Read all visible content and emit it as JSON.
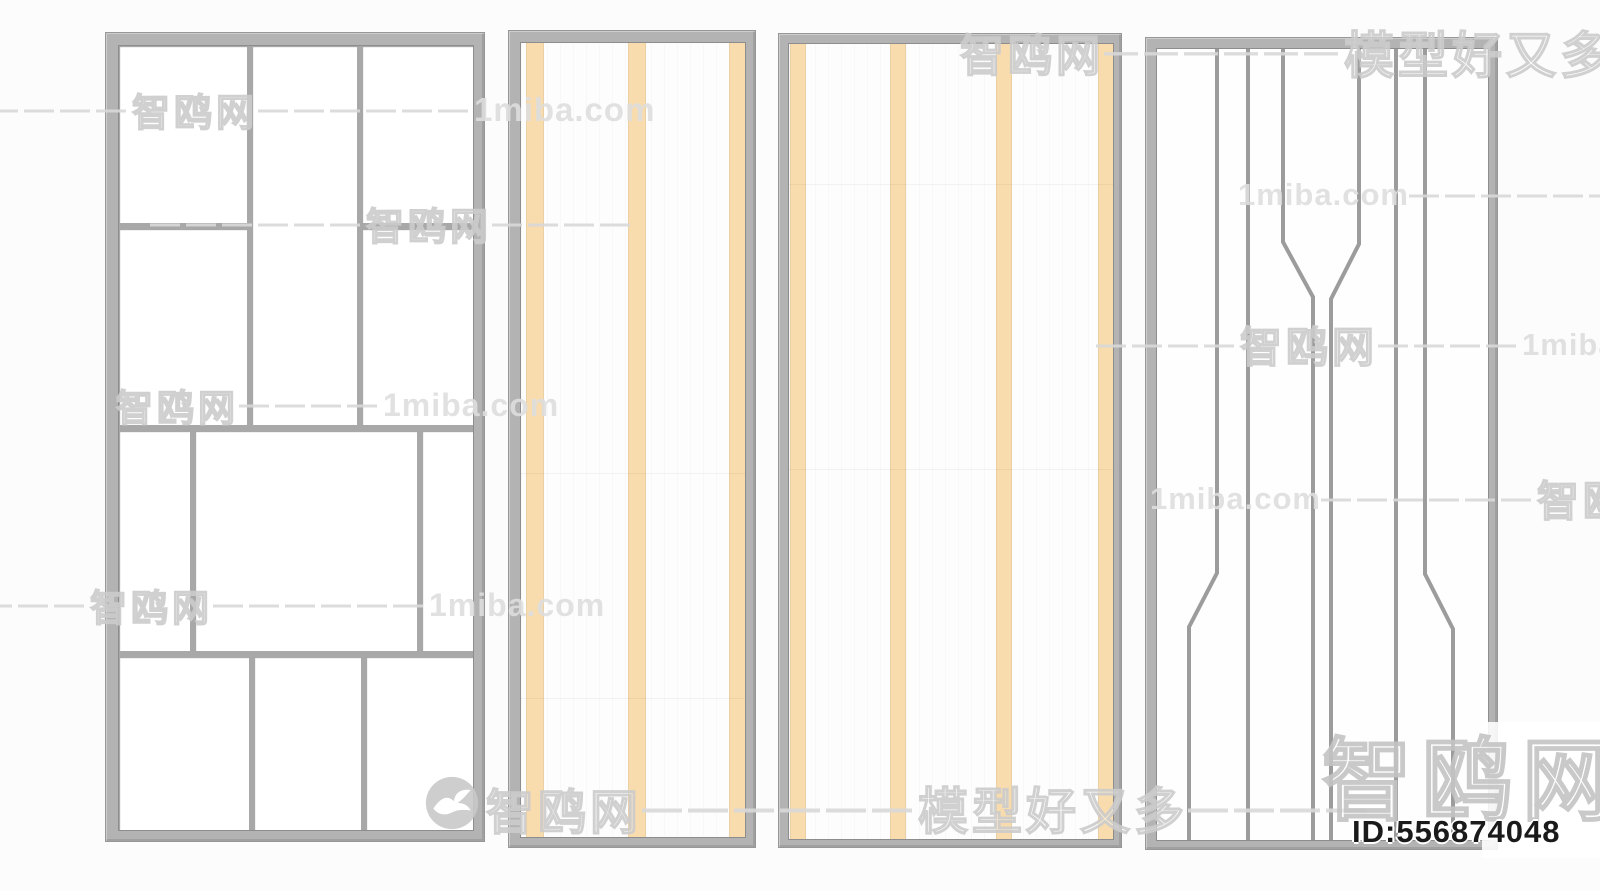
{
  "image": {
    "type": "3d-model-preview-render",
    "subject": "four decorative partition screen panels",
    "background_color": "#fcfcfc"
  },
  "watermarks": {
    "site_name": "智鸥网",
    "site_url": "1miba.com",
    "slogan": "模型好又多",
    "dashes_short": "———",
    "dashes_medium": "————",
    "dashes_long": "——————",
    "model_id": "ID:556874048"
  },
  "panels": [
    {
      "name": "grid-screen",
      "pattern": "rectangular mondrian grid",
      "frame_color": "#b3b3b3",
      "mullion_color": "#a8a8a8",
      "cell_color": "#ffffff"
    },
    {
      "name": "narrow-striped-screen",
      "pattern": "3 vertical orange stripes",
      "frame_color": "#b3b3b3",
      "stripe_color": "#f8dcae",
      "field_color": "#fdfdfd"
    },
    {
      "name": "wide-striped-screen",
      "pattern": "4 vertical orange stripes",
      "frame_color": "#b3b3b3",
      "stripe_color": "#f8dcae",
      "field_color": "#fdfdfd"
    },
    {
      "name": "line-screen",
      "pattern": "6 vertical lines with angled offsets",
      "frame_color": "#b3b3b3",
      "line_color": "#9c9c9c",
      "field_color": "#ffffff"
    }
  ]
}
